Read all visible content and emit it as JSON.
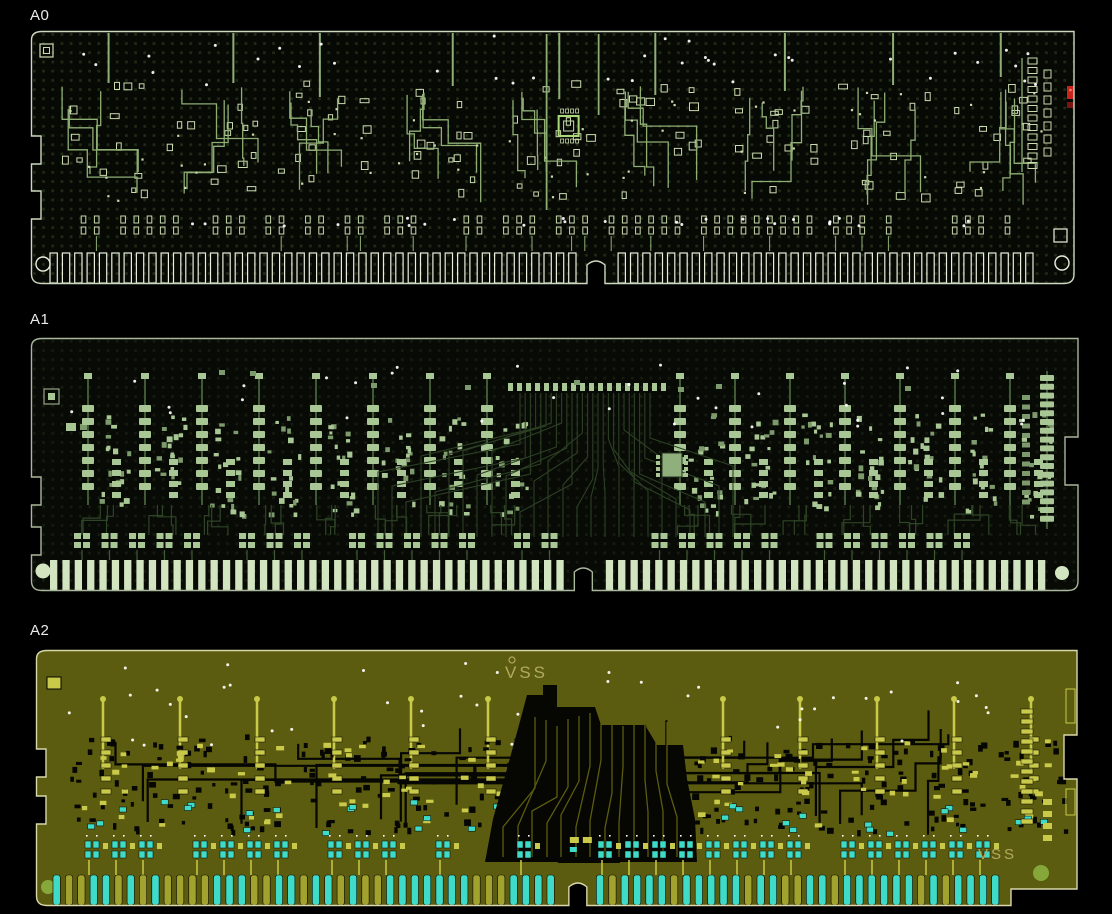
{
  "page": {
    "background": "#000000"
  },
  "panels": [
    {
      "id": "a0",
      "label": "A0",
      "layer_style": "outline",
      "notch_frac": 0.538,
      "finger_count": 80,
      "colors": {
        "bg": "#070905",
        "dot": "#212b15",
        "outline": "#ccd8bf",
        "trace": "#8fae74",
        "pad": "#c9daae",
        "finger": "#e8efdd",
        "via": "#ffffff",
        "marker_red": "#c8241c",
        "marker_red_dark": "#7a1512"
      },
      "texts": []
    },
    {
      "id": "a1",
      "label": "A1",
      "layer_style": "filled",
      "notch_frac": 0.524,
      "finger_count": 82,
      "colors": {
        "bg": "#080a06",
        "dot": "#151b0e",
        "outline": "#a9b79c",
        "trace": "#2e4426",
        "trace_light": "#3f5a35",
        "pad": "#a9c795",
        "pad_dark": "#7d9a6c",
        "finger": "#d2e5c0",
        "via": "#ffffff"
      },
      "texts": []
    },
    {
      "id": "a2",
      "label": "A2",
      "layer_style": "negative",
      "notch_frac": 0.517,
      "finger_count": 76,
      "colors": {
        "bg": "#5c5c10",
        "outline": "#d8d8ac",
        "trace": "#060602",
        "pad": "#c9c94a",
        "pad_cyan": "#3edbc8",
        "finger": "#3edbc8",
        "finger_alt": "#a2a22e",
        "via": "#ffffff",
        "text": "#b3aa5e",
        "hole": "#86a83a"
      },
      "texts": [
        {
          "text": "VSS",
          "x_frac": 0.448,
          "y_frac": 0.045,
          "size": 17
        },
        {
          "text": "VSS",
          "x_frac": 0.898,
          "y_frac": 0.755,
          "size": 15
        }
      ]
    }
  ]
}
